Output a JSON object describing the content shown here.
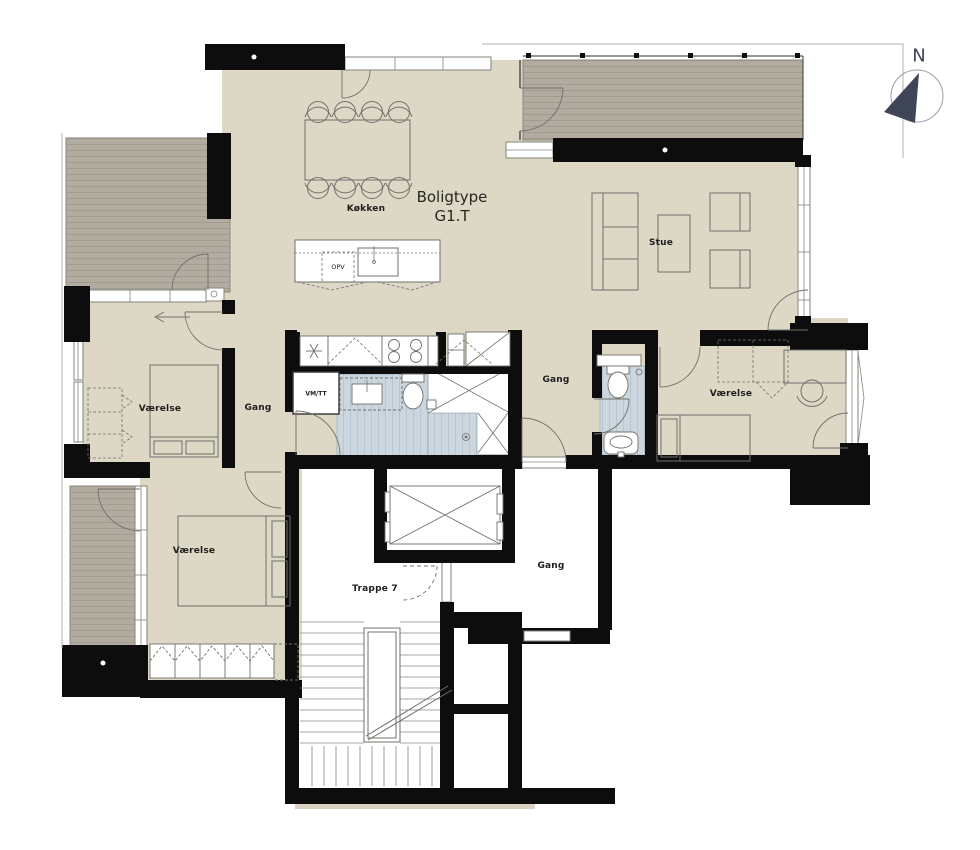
{
  "title": {
    "line1": "Boligtype",
    "line2": "G1.T"
  },
  "compass": {
    "north": "N"
  },
  "rooms": {
    "kitchen": "Køkken",
    "living": "Stue",
    "bedroom_left": "Værelse",
    "bedroom_right": "Værelse",
    "bedroom_lower": "Værelse",
    "hall_left": "Gang",
    "hall_center": "Gang",
    "hall_stairwell": "Gang",
    "staircase": "Trappe 7"
  },
  "appliances": {
    "dishwasher": "OPV",
    "washer_dryer": "VM/TT"
  },
  "colors": {
    "floor": "#ddd8c6",
    "deck": "#b1aba0",
    "wall": "#0d0d0d",
    "bath_tile": "#ccd6de",
    "compass": "#3e4557"
  }
}
